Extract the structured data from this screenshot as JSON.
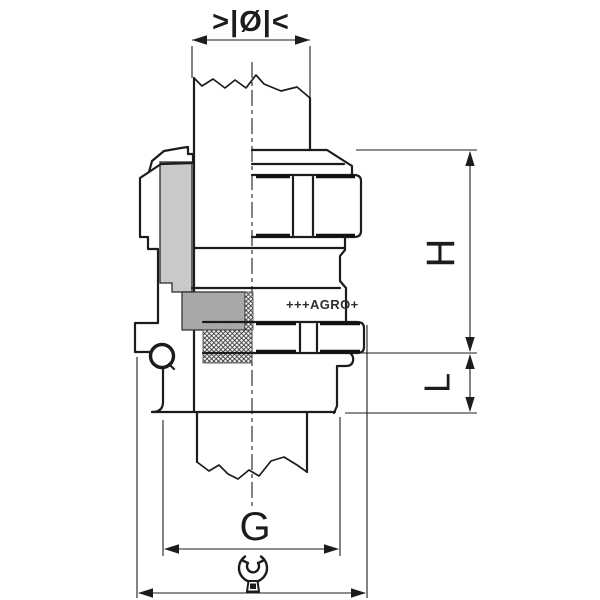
{
  "drawing": {
    "labels": {
      "cable_diameter_symbol": ">|Ø|<",
      "dimension_h": "H",
      "dimension_l": "L",
      "dimension_g": "G",
      "brand_marking": "+++AGRO+"
    },
    "icons": {
      "wrench": "open-end-wrench-icon"
    },
    "colors": {
      "background": "#ffffff",
      "line": "#1c1c1c",
      "insert_fill": "#cccccc",
      "seal_fill": "#ababab"
    }
  }
}
